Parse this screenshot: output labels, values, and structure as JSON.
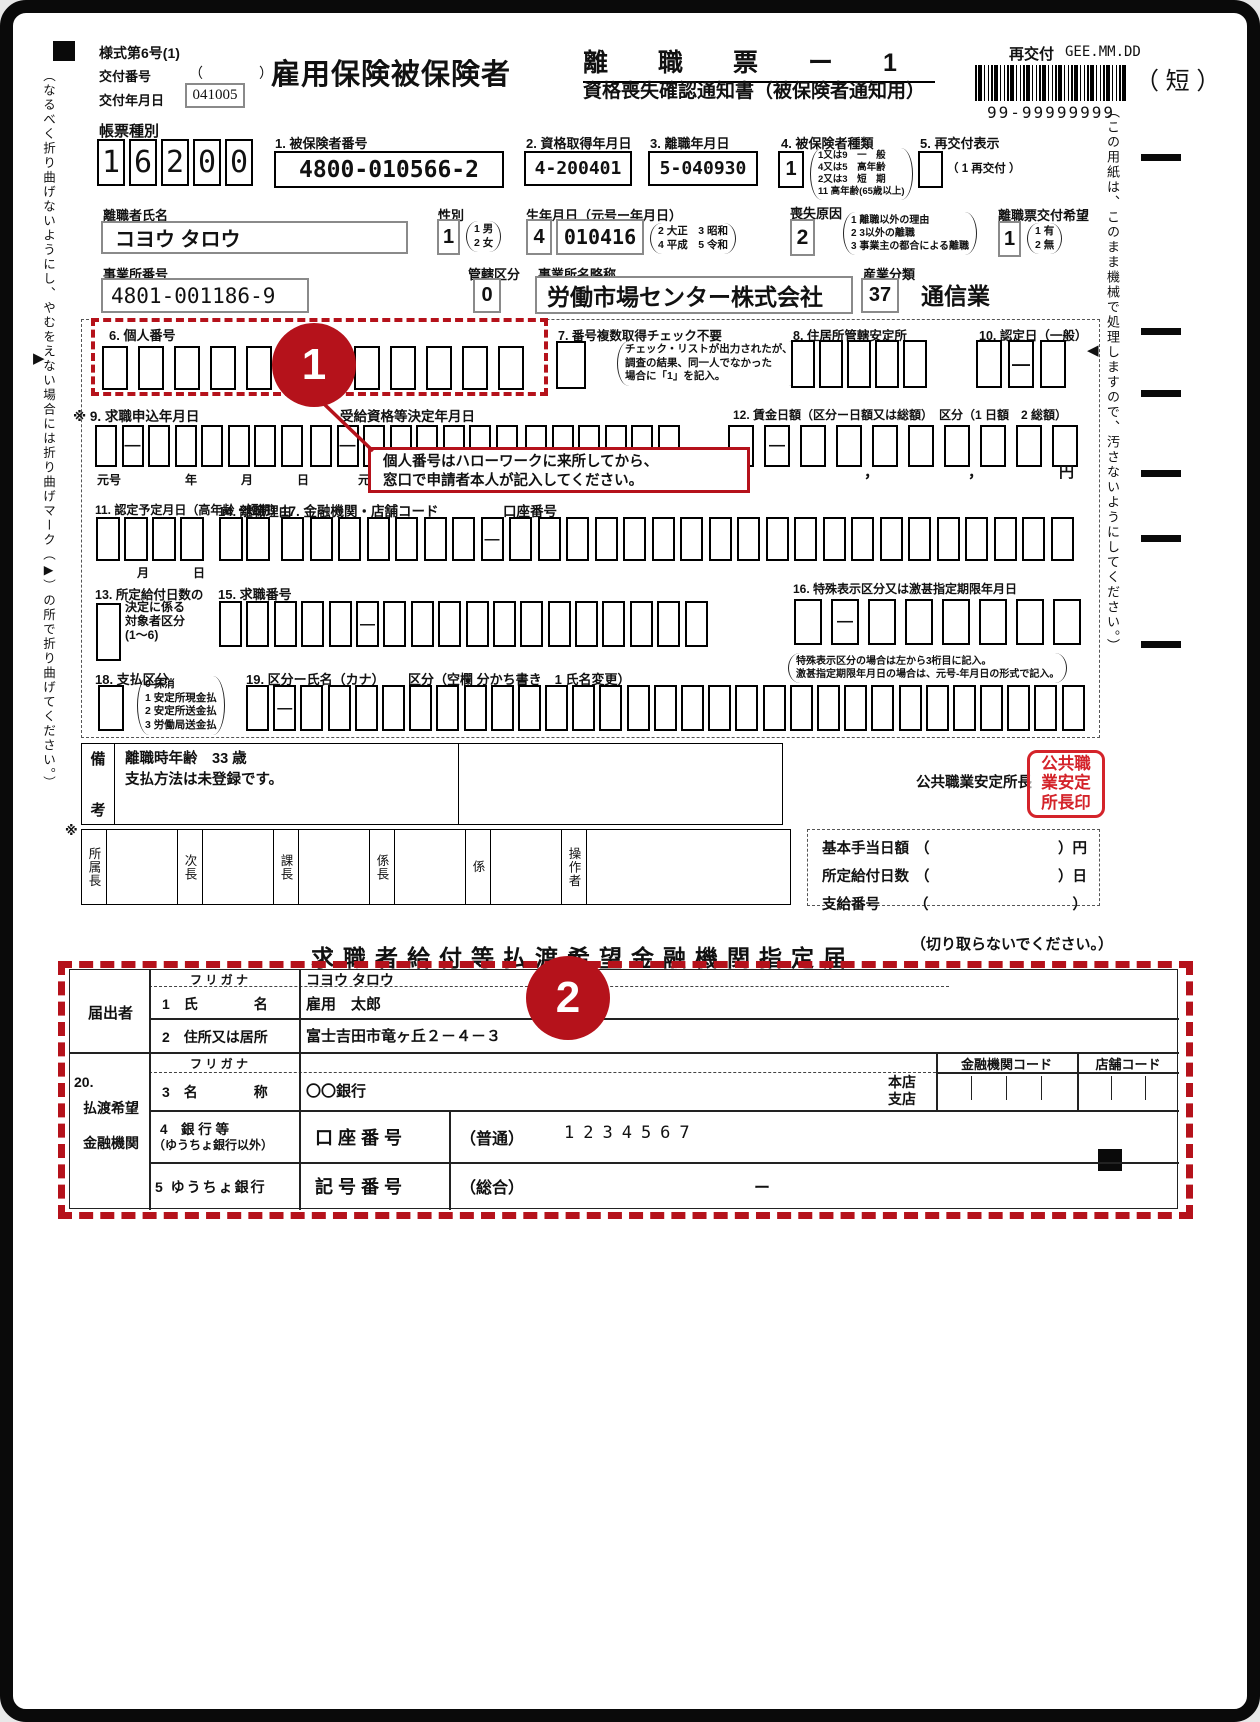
{
  "colors": {
    "accent_red": "#b5121b",
    "stamp_red": "#d4232a"
  },
  "glyphs": {
    "open": "（",
    "close": "）",
    "comma": "，",
    "fold_left": "▶",
    "fold_right": "◀",
    "asterisk": "※"
  },
  "header": {
    "form_code": "様式第6号(1)",
    "issue_no_label": "交付番号",
    "issue_no_value": "（　　　　）",
    "issue_date_label": "交付年月日",
    "issue_date_value": "041005",
    "title": "雇用保険被保険者",
    "title2": "離　　職　　票　　ー　　1",
    "title2_sub": "資格喪失確認通知書（被保険者通知用）",
    "reissue_label": "再交付",
    "reissue_value": "GEE.MM.DD",
    "barcode_number": "99-99999999",
    "short_label": "（ 短 ）"
  },
  "margins": {
    "left_note": "（なるべく折り曲げないようにし、やむをえない場合には折り曲げマーク（▶）の所で折り曲げてください。）",
    "right_note": "（この用紙は、このまま機械で処理しますので、汚さないようにしてください。）"
  },
  "keishu": {
    "label": "帳票種別",
    "boxes": [
      "1",
      "6",
      "2",
      "0",
      "0"
    ]
  },
  "fields": {
    "f1": {
      "label": "1. 被保険者番号",
      "value": "4800-010566-2"
    },
    "f2": {
      "label": "2. 資格取得年月日",
      "value": "4-200401"
    },
    "f3": {
      "label": "3. 離職年月日",
      "value": "5-040930"
    },
    "f4": {
      "label": "4. 被保険者種類",
      "value": "1",
      "notes": [
        "1又は9　一　般",
        "4又は5　高年齢",
        "2又は3　短　期",
        "11 高年齢(65歳以上)"
      ]
    },
    "f5": {
      "label": "5. 再交付表示",
      "note": "（ 1 再交付 ）"
    },
    "name": {
      "label": "離職者氏名",
      "value": "コヨウ タロウ"
    },
    "sex": {
      "label": "性別",
      "value": "1",
      "notes": [
        "1 男",
        "2 女"
      ]
    },
    "birth": {
      "label": "生年月日（元号ー年月日）",
      "era": "4",
      "value": "010416",
      "notes": [
        "2 大正　3 昭和",
        "4 平成　5 令和"
      ]
    },
    "loss": {
      "label": "喪失原因",
      "value": "2",
      "notes": [
        "1 離職以外の理由",
        "2 3以外の離職",
        "3 事業主の都合による離職"
      ]
    },
    "wish": {
      "label": "離職票交付希望",
      "value": "1",
      "notes": [
        "1 有",
        "2 無"
      ]
    },
    "office_no": {
      "label": "事業所番号",
      "value": "4801-001186-9"
    },
    "kankatsu": {
      "label": "管轄区分",
      "value": "0"
    },
    "office_name": {
      "label": "事業所名略称",
      "value": "労働市場センター株式会社"
    },
    "industry": {
      "label": "産業分類",
      "value": "37",
      "text": "通信業"
    },
    "f6": {
      "label": "6. 個人番号",
      "boxes": [
        "",
        "",
        "",
        "",
        "",
        "",
        "",
        "",
        "",
        "",
        "",
        ""
      ]
    },
    "f7": {
      "label": "7. 番号複数取得チェック不要",
      "boxes": [
        ""
      ],
      "notes": [
        "チェック・リストが出力されたが、",
        "調査の結果、同一人でなかった",
        "場合に「1」を記入。"
      ]
    },
    "f8": {
      "label": "8. 住居所管轄安定所",
      "boxes": [
        "",
        "",
        "",
        "",
        ""
      ]
    },
    "f10": {
      "label": "10. 認定日（一般）",
      "boxes": [
        "",
        "-",
        ""
      ]
    },
    "f9": {
      "label": "※ 9. 求職申込年月日",
      "boxes": [
        "",
        "-",
        "",
        "",
        "",
        "",
        "",
        ""
      ],
      "sublabels": [
        "元号",
        "年",
        "月",
        "日"
      ],
      "label2": "受給資格等決定年月日",
      "boxes2": [
        "",
        "-",
        "",
        "",
        "",
        "",
        "",
        ""
      ],
      "boxes2b": [
        "",
        "",
        "",
        "",
        "",
        ""
      ],
      "sublabel2": "元号"
    },
    "f12": {
      "label": "12. 賃金日額（区分ー日額又は総額）　区分（1 日額　2 総額）",
      "boxes": [
        "",
        "-",
        "",
        "",
        "",
        "",
        "",
        "",
        "",
        ""
      ],
      "unit": "円"
    },
    "f11": {
      "label": "11. 認定予定月日（高年齢・短期）",
      "boxes": [
        "",
        "",
        "",
        ""
      ],
      "sublabels": [
        "月",
        "日"
      ]
    },
    "f14": {
      "label": "14. 離職理由",
      "boxes": [
        "",
        ""
      ]
    },
    "f17": {
      "label": "17. 金融機関・店舗コード",
      "label2": "口座番号",
      "boxes": [
        "",
        "",
        "",
        "",
        "",
        "",
        "",
        "-",
        "",
        "",
        "",
        "",
        "",
        "",
        "",
        "",
        "",
        "",
        "",
        "",
        "",
        "",
        "",
        "",
        "",
        "",
        "",
        ""
      ]
    },
    "f13": {
      "label": "13. 所定給付日数の",
      "lines": [
        "決定に係る",
        "対象者区分",
        "(1～6)"
      ],
      "boxes": [
        ""
      ]
    },
    "f15": {
      "label": "15. 求職番号",
      "boxes": [
        "",
        "",
        "",
        "",
        "",
        "-",
        "",
        "",
        "",
        "",
        "",
        "",
        "",
        "",
        "",
        "",
        "",
        ""
      ]
    },
    "f16": {
      "label": "16. 特殊表示区分又は激甚指定期限年月日",
      "boxes": [
        "",
        "-",
        "",
        "",
        "",
        "",
        "",
        ""
      ],
      "notes": [
        "特殊表示区分の場合は左から3桁目に記入。",
        "激甚指定期限年月日の場合は、元号-年月日の形式で記入。"
      ]
    },
    "f18": {
      "label": "18. 支払区分",
      "boxes": [
        ""
      ],
      "notes": [
        "0 抹消",
        "1 安定所現金払",
        "2 安定所送金払",
        "3 労働局送金払"
      ]
    },
    "f19": {
      "label": "19. 区分ー氏名（カナ）",
      "label2": "区分（空欄 分かち書き　1 氏名変更）",
      "boxes": [
        "",
        "-",
        "",
        "",
        "",
        "",
        "",
        "",
        "",
        "",
        "",
        "",
        "",
        "",
        "",
        "",
        "",
        "",
        "",
        "",
        "",
        "",
        "",
        "",
        "",
        "",
        "",
        "",
        "",
        "",
        ""
      ]
    }
  },
  "personal_note": {
    "lines": [
      "個人番号はハローワークに来所してから、",
      "窓口で申請者本人が記入してください。"
    ]
  },
  "annotations": {
    "n1": "1",
    "n2": "2"
  },
  "biko": {
    "label_chars": [
      "備",
      "考"
    ],
    "lines": [
      "離職時年齢　33 歳",
      "支払方法は未登録です。"
    ]
  },
  "stamp": {
    "label": "公共職業安定所長",
    "lines": [
      "公共職",
      "業安定",
      "所長印"
    ]
  },
  "approval": {
    "prefix": "※",
    "cells": [
      "所属長",
      "次長",
      "課長",
      "係長",
      "係",
      "操作者"
    ]
  },
  "benefits": {
    "rows": [
      {
        "label": "基本手当日額",
        "unit": "円"
      },
      {
        "label": "所定給付日数",
        "unit": "日"
      },
      {
        "label": "支給番号",
        "unit": ""
      }
    ]
  },
  "cut_note": "（切り取らないでください。）",
  "bottom": {
    "title": "求職者給付等払渡希望金融機関指定届",
    "group1": "届出者",
    "furigana_label": "フ リ ガ ナ",
    "furigana_value": "コヨウ タロウ",
    "name_label": "1　氏　　　　名",
    "name_value": "雇用　太郎",
    "addr_label": "2　住所又は居所",
    "addr_value": "富士吉田市竜ヶ丘２－４－３",
    "group2_lines": [
      "20.",
      "払渡希望",
      "金融機関"
    ],
    "furigana2_label": "フ リ ガ ナ",
    "branch_lines": [
      "本店",
      "支店"
    ],
    "bank_code_header": "金融機関コード",
    "branch_code_header": "店舗コード",
    "bank_label": "3　名　　　　称",
    "bank_value": "〇〇銀行",
    "acct_label1": "4　銀 行 等",
    "acct_label2": "（ゆうちょ銀行以外）",
    "acct_field": "口 座 番 号",
    "acct_type": "（普通）",
    "acct_value": "1234567",
    "yucho_label": "5 ゆうちょ銀行",
    "yucho_field": "記 号 番 号",
    "yucho_type": "（総合）",
    "yucho_dash": "ー"
  }
}
